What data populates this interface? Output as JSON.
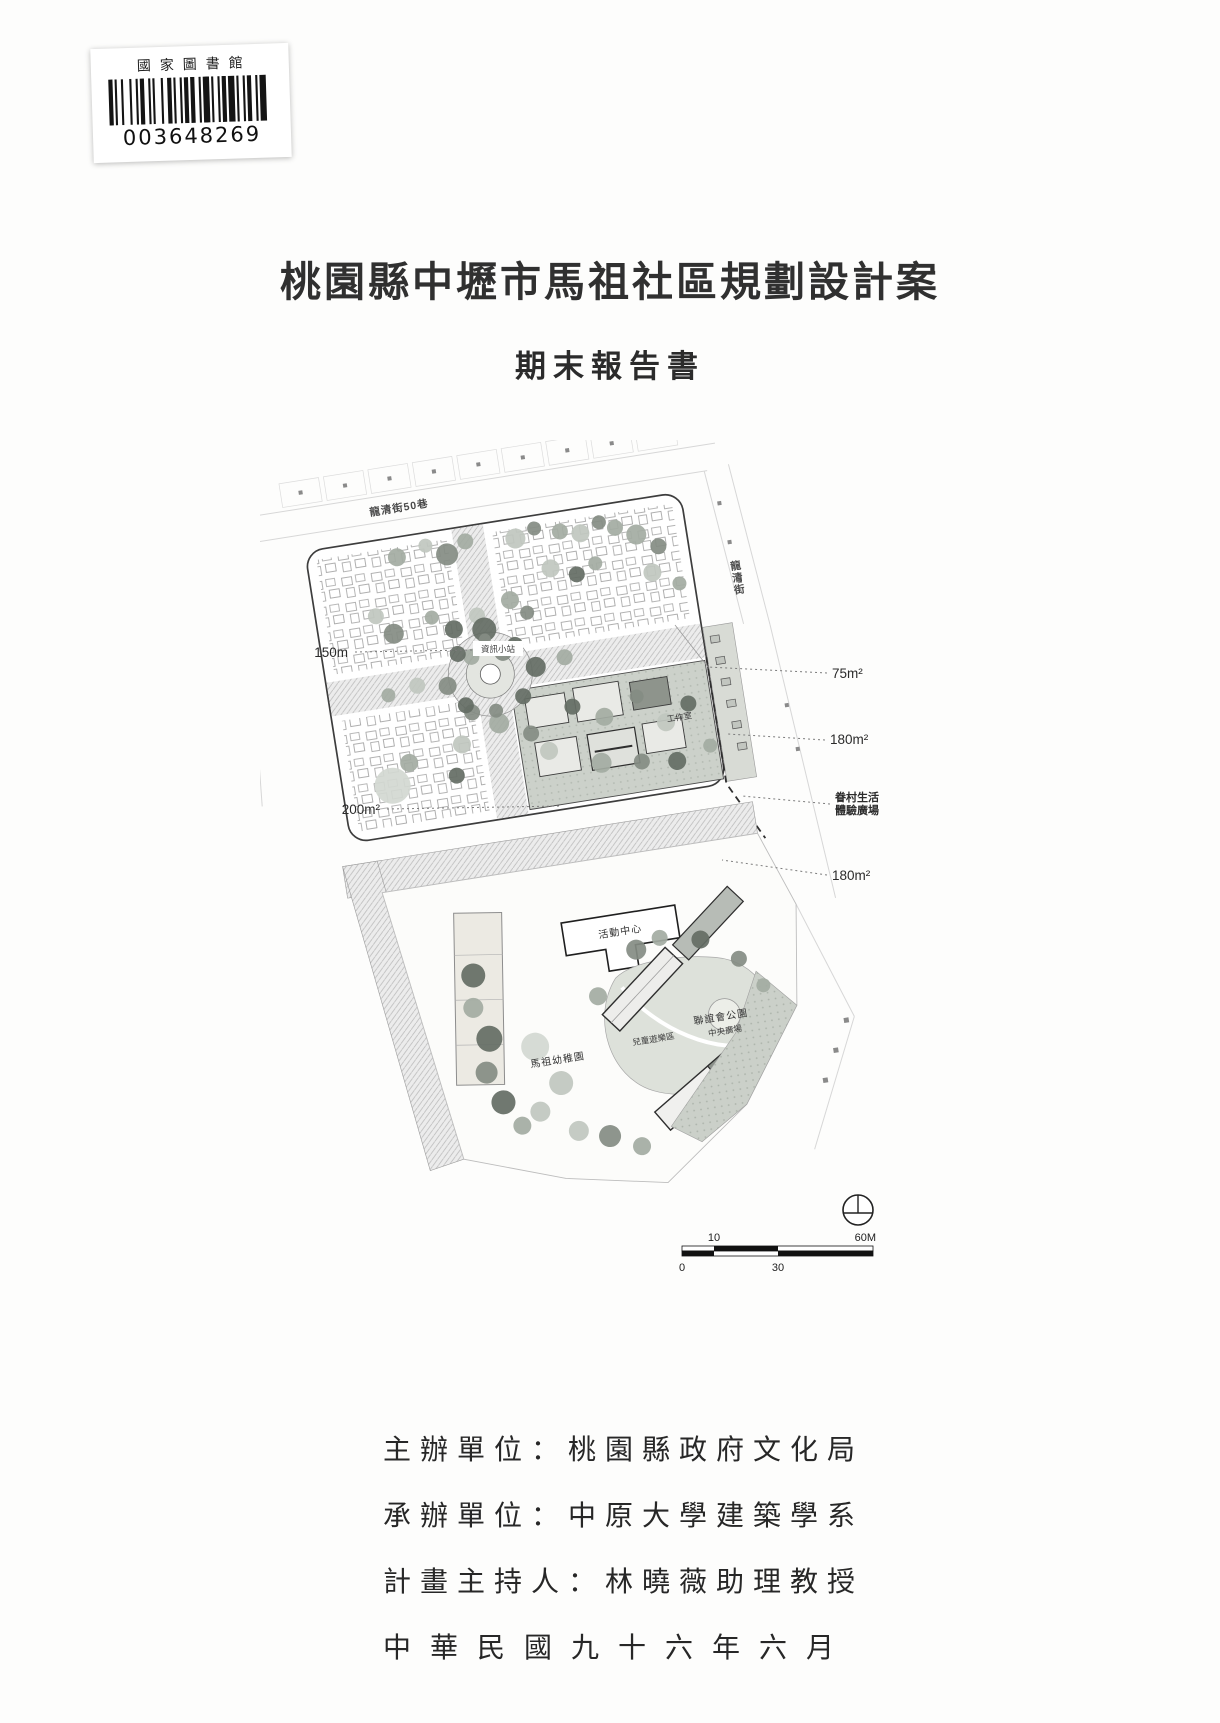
{
  "barcode": {
    "library": "國家圖書館",
    "number": "003648269"
  },
  "titles": {
    "main": "桃園縣中壢市馬祖社區規劃設計案",
    "sub": "期末報告書"
  },
  "site_plan": {
    "street_top": "龍清街50巷",
    "street_right": "龍清街",
    "callout_150m": "150m",
    "callout_200m2": "200m²",
    "callout_75m2": "75m²",
    "callout_180m2_upper": "180m²",
    "callout_village_line1": "眷村生活",
    "callout_village_line2": "體驗廣場",
    "callout_180m2_lower": "180m²",
    "label_info_station": "資訊小站",
    "label_workshop": "工作室",
    "label_activity_center": "活動中心",
    "label_kindergarten": "馬祖幼稚園",
    "label_park": "聯誼會公園",
    "label_central_plaza": "中央廣場",
    "label_playground": "兒童遊樂區",
    "scale": {
      "ten": "10",
      "sixty": "60M",
      "zero": "0",
      "thirty": "30"
    }
  },
  "footer": {
    "line1": "主辦單位：桃園縣政府文化局",
    "line2": "承辦單位：中原大學建築學系",
    "line3": "計畫主持人：林曉薇助理教授",
    "line4": "中華民國九十六年六月"
  }
}
